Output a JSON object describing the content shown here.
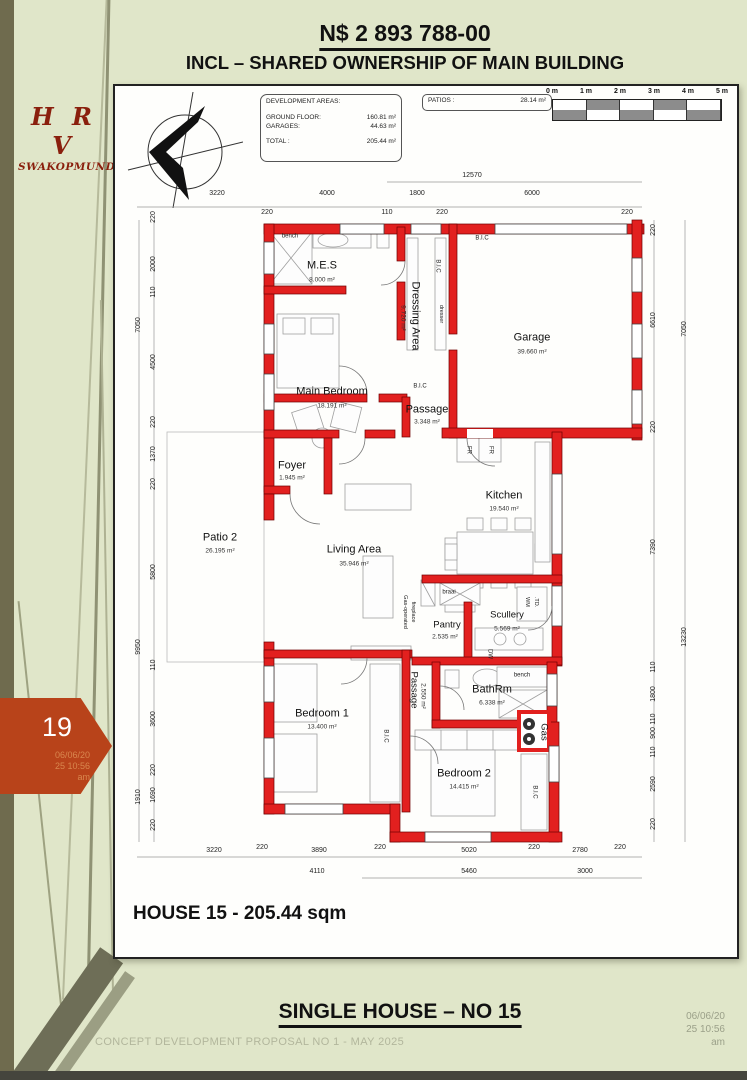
{
  "header": {
    "price": "N$ 2 893 788-00",
    "subtitle": "INCL – SHARED OWNERSHIP OF MAIN BUILDING"
  },
  "logo": {
    "initials": "H R V",
    "city": "SWAKOPMUND"
  },
  "dev_areas": {
    "title": "DEVELOPMENT AREAS:",
    "ground_floor_label": "GROUND FLOOR:",
    "ground_floor_value": "160.81 m²",
    "garages_label": "GARAGES:",
    "garages_value": "44.63 m²",
    "total_label": "TOTAL :",
    "total_value": "205.44 m²"
  },
  "patios": {
    "label": "PATIOS :",
    "value": "28.14 m²"
  },
  "scale_bar": {
    "labels": [
      "0 m",
      "1 m",
      "2 m",
      "3 m",
      "4 m",
      "5 m"
    ]
  },
  "rooms": [
    {
      "name": "M.E.S",
      "area": "8.000 m²"
    },
    {
      "name": "Dressing Area",
      "area": "9.720 m²"
    },
    {
      "name": "Main Bedroom",
      "area": "18.191 m²"
    },
    {
      "name": "Garage",
      "area": "39.660 m²"
    },
    {
      "name": "Passage",
      "area": "3.348 m²"
    },
    {
      "name": "Foyer",
      "area": "1.945 m²"
    },
    {
      "name": "Kitchen",
      "area": "19.540 m²"
    },
    {
      "name": "Patio 2",
      "area": "26.195 m²"
    },
    {
      "name": "Living Area",
      "area": "35.946 m²"
    },
    {
      "name": "Pantry",
      "area": "2.535 m²"
    },
    {
      "name": "Scullery",
      "area": "5.569 m²"
    },
    {
      "name": "Passage",
      "area": "2.550 m²"
    },
    {
      "name": "BathRm",
      "area": "6.338 m²"
    },
    {
      "name": "Bedroom 1",
      "area": "13.400 m²"
    },
    {
      "name": "Bedroom 2",
      "area": "14.415 m²"
    }
  ],
  "fixtures": {
    "bench1": "bench",
    "bic_top": "B.I.C",
    "bic_dressing": "B.I.C",
    "dresser": "dresser",
    "bic_below": "B.I.C",
    "fr1": "FR",
    "fr2": "FR",
    "braai": "braai",
    "wm": "WM",
    "td": ".TD.",
    "dw": "DW",
    "bench2": "bench",
    "fireplace1": "Gas-operated",
    "fireplace2": "fireplace",
    "bic_bed1": "B.I.C",
    "bic_bed2": "B.I.C",
    "gas": "Gas"
  },
  "dims": {
    "top_overall": "12570",
    "top": [
      "3220",
      "4000",
      "1800",
      "6000"
    ],
    "top_small": [
      "220",
      "110",
      "220",
      "220"
    ],
    "left_outer": [
      "7050",
      "9950",
      "1910"
    ],
    "left_inner": [
      "220",
      "2000",
      "110",
      "4500",
      "220",
      "1370",
      "220",
      "5800",
      "110",
      "3600",
      "220",
      "1690",
      "220"
    ],
    "right_inner": [
      "220",
      "6610",
      "220",
      "7390",
      "110",
      "1800",
      "110",
      "900",
      "110",
      "2590",
      "220"
    ],
    "right_outer": [
      "7050",
      "13230"
    ],
    "bottom_row1": [
      "3220",
      "220",
      "3890",
      "220",
      "5020",
      "220",
      "2780",
      "220"
    ],
    "bottom_row2": [
      "4110",
      "5460",
      "3000"
    ]
  },
  "plan_title": "HOUSE 15 - 205.44 sqm",
  "badge": {
    "number": "19",
    "line1": "06/06/20",
    "line2": "25 10:56",
    "line3": "am"
  },
  "footer": {
    "title": "SINGLE HOUSE – NO 15",
    "proposal": "CONCEPT DEVELOPMENT PROPOSAL NO 1 - MAY 2025",
    "date": "06/06/20",
    "time": "25 10:56",
    "ampm": "am"
  },
  "colors": {
    "wall": "#e2201f",
    "badge": "#b8431a",
    "background": "#e0e6c9",
    "left_band": "#6f6b4e",
    "logo_red": "#8a1f0d"
  }
}
